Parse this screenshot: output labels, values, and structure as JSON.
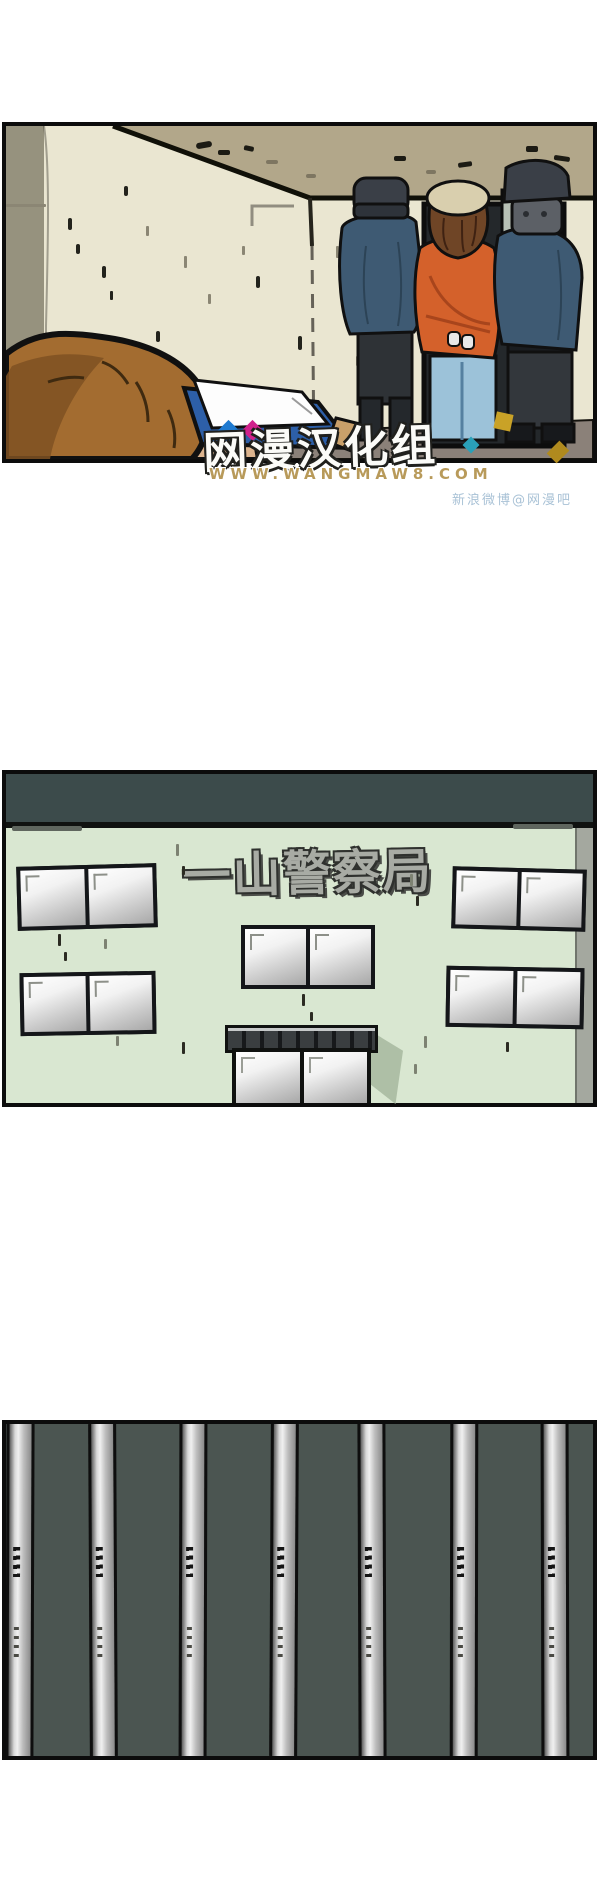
{
  "page": {
    "background": "#ffffff",
    "width": 600,
    "height": 1897
  },
  "panel1": {
    "label": "arrest-scene",
    "colors": {
      "wall": "#eae6d1",
      "side_wall": "#96927e",
      "ceiling": "#b2a78a",
      "floor": "#8b8179",
      "doorway": "#24282b",
      "door_glass": "#74979f",
      "outside_view": "#b8c1b6",
      "officer_jacket": "#3e5a73",
      "officer_cap": "#3a3f47",
      "officer_pants": "#2e3236",
      "prisoner_jacket": "#d4612b",
      "prisoner_cap": "#d9cfae",
      "prisoner_hair": "#6f4526",
      "prisoner_jeans": "#9cc2d9",
      "foreground_hair": "#a36c30",
      "skin": "#dcb48e",
      "clipboard": "#2d5fa8",
      "paper": "#fdfdfd"
    }
  },
  "watermark": {
    "logo": "网漫汉化组",
    "url": "WWW.WANGMAW8.COM",
    "weibo": "新浪微博@网漫吧",
    "colors": {
      "blue": "#1f7ad0",
      "magenta": "#d0218c",
      "gold": "#c9a227",
      "teal": "#2aa0b8",
      "url_text": "#b89a5a",
      "weibo_text": "#a9c2d6"
    }
  },
  "panel2": {
    "label": "police-station-exterior",
    "sign": "一山警察局",
    "colors": {
      "sky": "#3c4b4b",
      "facade": "#d9e7d1",
      "building_side": "#a4a89f",
      "sign_fill": "#a8aba4",
      "window_frame": "#141619",
      "door_shadow": "#aebfa6"
    }
  },
  "panel3": {
    "label": "jail-bars",
    "bar_count": 7,
    "colors": {
      "background": "#4b5551",
      "bar_highlight": "#f0f0f0",
      "bar_mid": "#bdbdbd",
      "bar_edge": "#0e0e0e"
    }
  }
}
